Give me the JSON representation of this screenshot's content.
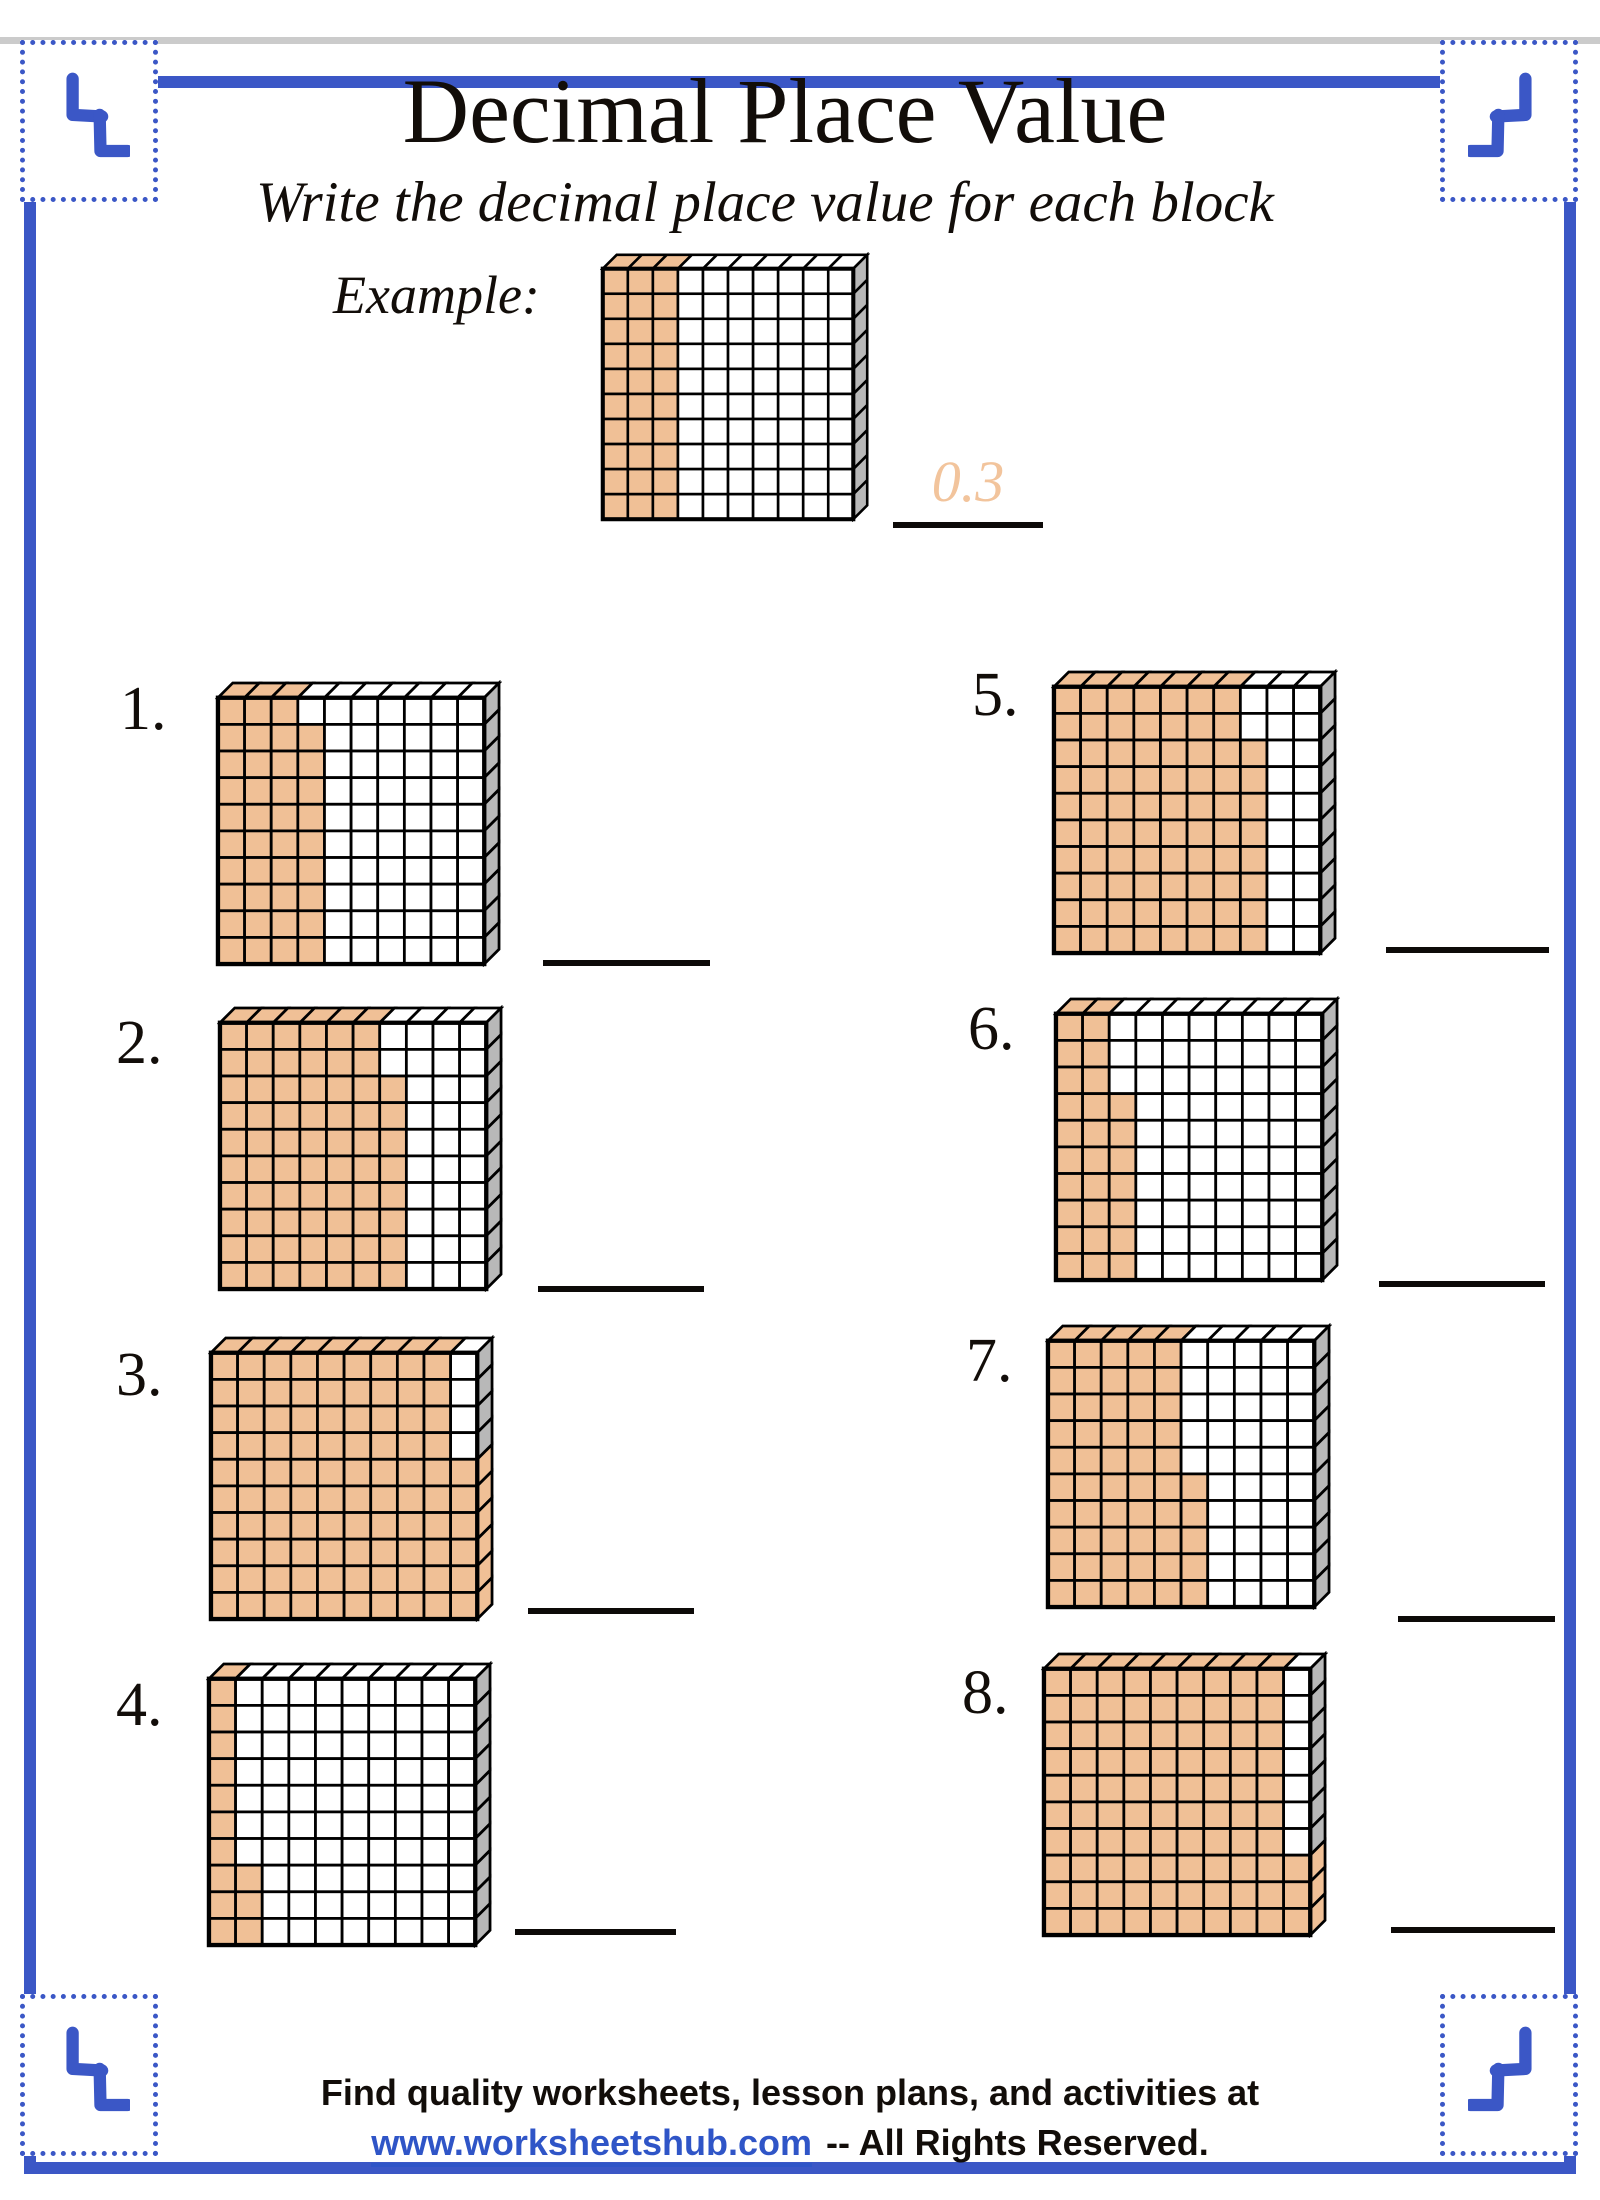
{
  "page": {
    "title": "Decimal Place Value",
    "subtitle": "Write the decimal place value for each block"
  },
  "example": {
    "label": "Example:",
    "shaded_hundredths": 30,
    "answer": "0.3"
  },
  "problems": [
    {
      "number": "1.",
      "shaded_hundredths": 39
    },
    {
      "number": "2.",
      "shaded_hundredths": 68
    },
    {
      "number": "3.",
      "shaded_hundredths": 96
    },
    {
      "number": "4.",
      "shaded_hundredths": 13
    },
    {
      "number": "5.",
      "shaded_hundredths": 78
    },
    {
      "number": "6.",
      "shaded_hundredths": 27
    },
    {
      "number": "7.",
      "shaded_hundredths": 55
    },
    {
      "number": "8.",
      "shaded_hundredths": 93
    }
  ],
  "grid": {
    "rows": 10,
    "cols": 10,
    "shade_color": "#f0c096",
    "side_color": "#b8b8b8",
    "line_color": "#000000",
    "cell_bg": "#ffffff"
  },
  "colors": {
    "frame_blue": "#3b57c6",
    "link_blue": "#2f55c7",
    "answer_orange": "#f2c49c"
  },
  "footer": {
    "line1": "Find quality worksheets, lesson plans, and activities at",
    "link": "www.worksheetshub.com",
    "suffix": "-- All Rights Reserved."
  }
}
